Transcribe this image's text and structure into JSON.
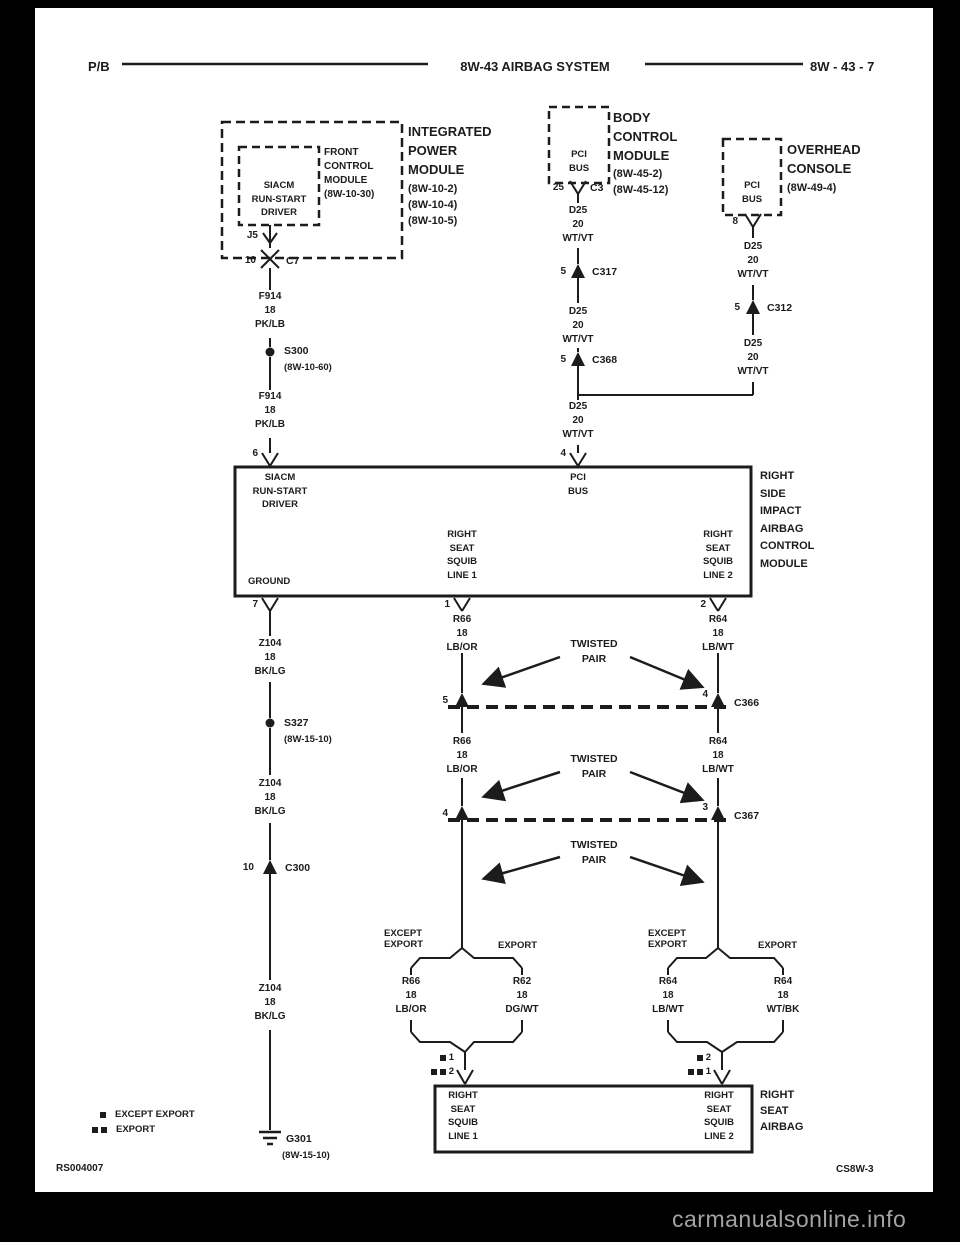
{
  "header": {
    "left": "P/B",
    "title": "8W-43 AIRBAG SYSTEM",
    "right": "8W - 43 - 7"
  },
  "ipm": {
    "title": "INTEGRATED\nPOWER\nMODULE",
    "refs": "(8W-10-2)\n(8W-10-4)\n(8W-10-5)",
    "fcm": {
      "label": "FRONT\nCONTROL\nMODULE\n(8W-10-30)",
      "function": "SIACM\nRUN-START\nDRIVER",
      "pin": "J5"
    },
    "connector": {
      "pin": "10",
      "name": "C7"
    }
  },
  "bcm": {
    "title": "BODY\nCONTROL\nMODULE",
    "refs": "(8W-45-2)\n(8W-45-12)",
    "bus": "PCI\nBUS",
    "pin": "25",
    "conn": "C3"
  },
  "console": {
    "title": "OVERHEAD\nCONSOLE",
    "refs": "(8W-49-4)",
    "bus": "PCI\nBUS",
    "pin": "8"
  },
  "siacm": {
    "label": "RIGHT\nSIDE\nIMPACT\nAIRBAG\nCONTROL\nMODULE",
    "run_start": "SIACM\nRUN-START\nDRIVER",
    "pci": "PCI\nBUS",
    "ground": "GROUND",
    "squib1": "RIGHT\nSEAT\nSQUIB\nLINE 1",
    "squib2": "RIGHT\nSEAT\nSQUIB\nLINE 2",
    "pin_run_start": "6",
    "pin_pci": "4",
    "pin_ground": "7",
    "pin_squib1": "1",
    "pin_squib2": "2"
  },
  "airbag": {
    "label": "RIGHT\nSEAT\nAIRBAG",
    "squib1": "RIGHT\nSEAT\nSQUIB\nLINE 1",
    "squib2": "RIGHT\nSEAT\nSQUIB\nLINE 2",
    "pin1_std": "1",
    "pin1_exp": "2",
    "pin2_std": "2",
    "pin2_exp": "1"
  },
  "wires": {
    "f914": "F914\n18\nPK/LB",
    "d25": "D25\n20\nWT/VT",
    "z104": "Z104\n18\nBK/LG",
    "r66": "R66\n18\nLB/OR",
    "r64": "R64\n18\nLB/WT",
    "r62": "R62\n18\nDG/WT",
    "r64e": "R64\n18\nWT/BK"
  },
  "splices": {
    "s300": {
      "name": "S300",
      "ref": "(8W-10-60)"
    },
    "s327": {
      "name": "S327",
      "ref": "(8W-15-10)"
    }
  },
  "ground": {
    "name": "G301",
    "ref": "(8W-15-10)"
  },
  "connectors": {
    "c317": {
      "pin": "5",
      "name": "C317"
    },
    "c368": {
      "pin": "5",
      "name": "C368"
    },
    "c312": {
      "pin": "5",
      "name": "C312"
    },
    "c300": {
      "pin": "10",
      "name": "C300"
    },
    "c366": {
      "pin_left": "5",
      "pin_right": "4",
      "name": "C366"
    },
    "c367": {
      "pin_left": "4",
      "pin_right": "3",
      "name": "C367"
    }
  },
  "notes": {
    "twisted_pair": "TWISTED\nPAIR",
    "except_export": "EXCEPT\nEXPORT",
    "export": "EXPORT"
  },
  "legend": {
    "except_export": "EXCEPT EXPORT",
    "export": "EXPORT"
  },
  "footer": {
    "left": "RS004007",
    "right": "CS8W-3",
    "watermark": "carmanualsonline.info"
  }
}
